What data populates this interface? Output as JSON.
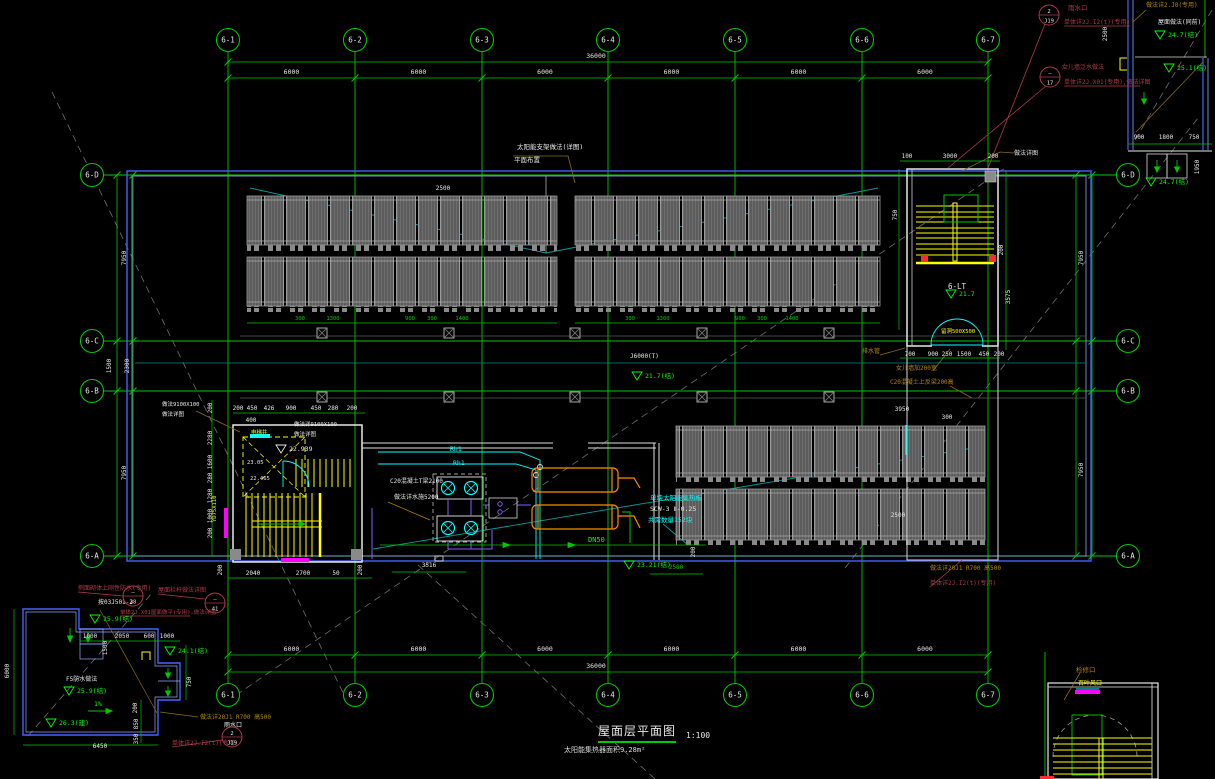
{
  "canvas": {
    "w": 1215,
    "h": 779
  },
  "palette": {
    "grid": "#00c800",
    "bright_green": "#00ff00",
    "white": "#e8e8e8",
    "cyan": "#00ffff",
    "teal": "#008c8c",
    "yellow": "#ffff00",
    "magenta": "#ff00ff",
    "orange": "#ff8c00",
    "tan": "#b8860b",
    "darkred": "#b03a48",
    "blue": "#4762ff",
    "red": "#ff2a2a",
    "panel_gray": "#787878"
  },
  "title": {
    "text": "屋面层平面图",
    "scale": "1:100",
    "note": "太阳能集热器面积9.28m²"
  },
  "axes": {
    "cols": [
      {
        "label": "6-1",
        "x": 228
      },
      {
        "label": "6-2",
        "x": 355
      },
      {
        "label": "6-3",
        "x": 482
      },
      {
        "label": "6-4",
        "x": 608
      },
      {
        "label": "6-5",
        "x": 735
      },
      {
        "label": "6-6",
        "x": 862
      },
      {
        "label": "6-7",
        "x": 988
      }
    ],
    "rows": [
      {
        "label": "6-D",
        "y": 175
      },
      {
        "label": "6-C",
        "y": 341
      },
      {
        "label": "6-B",
        "y": 391
      },
      {
        "label": "6-A",
        "y": 556
      }
    ],
    "col_bay_dim": "6000",
    "col_total_dim": "36000",
    "row_dims": [
      {
        "t": "7950",
        "x": 126,
        "y": 258,
        "r": 1
      },
      {
        "t": "1500",
        "x": 111,
        "y": 366,
        "r": 1
      },
      {
        "t": "2300",
        "x": 129,
        "y": 366,
        "r": 1
      },
      {
        "t": "7950",
        "x": 126,
        "y": 473,
        "r": 1
      },
      {
        "t": "7950",
        "x": 1083,
        "y": 258,
        "r": 1
      },
      {
        "t": "7950",
        "x": 1083,
        "y": 470,
        "r": 1
      }
    ]
  },
  "dims": [
    {
      "t": "2500",
      "x": 443,
      "y": 190
    },
    {
      "t": "100",
      "x": 907,
      "y": 158
    },
    {
      "t": "3000",
      "x": 950,
      "y": 158
    },
    {
      "t": "200",
      "x": 993,
      "y": 158
    },
    {
      "t": "200",
      "x": 1003,
      "y": 250,
      "r": 1
    },
    {
      "t": "3575",
      "x": 1010,
      "y": 297,
      "r": 1
    },
    {
      "t": "750",
      "x": 897,
      "y": 215,
      "r": 1
    },
    {
      "t": "700",
      "x": 910,
      "y": 356
    },
    {
      "t": "900",
      "x": 933,
      "y": 356
    },
    {
      "t": "250",
      "x": 947,
      "y": 356
    },
    {
      "t": "1500",
      "x": 964,
      "y": 356
    },
    {
      "t": "450",
      "x": 984,
      "y": 356
    },
    {
      "t": "200",
      "x": 999,
      "y": 356
    },
    {
      "t": "3950",
      "x": 902,
      "y": 411
    },
    {
      "t": "300",
      "x": 947,
      "y": 419
    },
    {
      "t": "2500",
      "x": 898,
      "y": 517
    },
    {
      "t": "200",
      "x": 238,
      "y": 410
    },
    {
      "t": "450",
      "x": 252,
      "y": 410
    },
    {
      "t": "426",
      "x": 269,
      "y": 410
    },
    {
      "t": "900",
      "x": 291,
      "y": 410
    },
    {
      "t": "450",
      "x": 316,
      "y": 410
    },
    {
      "t": "280",
      "x": 333,
      "y": 410
    },
    {
      "t": "200",
      "x": 352,
      "y": 410
    },
    {
      "t": "400",
      "x": 251,
      "y": 422
    },
    {
      "t": "200",
      "x": 222,
      "y": 570,
      "r": 1
    },
    {
      "t": "2040",
      "x": 253,
      "y": 575
    },
    {
      "t": "2700",
      "x": 303,
      "y": 575
    },
    {
      "t": "50",
      "x": 336,
      "y": 575
    },
    {
      "t": "200",
      "x": 362,
      "y": 570,
      "r": 1
    },
    {
      "t": "3516",
      "x": 429,
      "y": 567
    },
    {
      "t": "2500",
      "x": 676,
      "y": 569,
      "c": "g"
    },
    {
      "t": "200",
      "x": 695,
      "y": 552,
      "r": 1
    },
    {
      "t": "200",
      "x": 212,
      "y": 408,
      "r": 1
    },
    {
      "t": "2280",
      "x": 212,
      "y": 438,
      "r": 1
    },
    {
      "t": "1600",
      "x": 212,
      "y": 462,
      "r": 1
    },
    {
      "t": "280",
      "x": 212,
      "y": 478,
      "r": 1
    },
    {
      "t": "1280",
      "x": 212,
      "y": 496,
      "r": 1
    },
    {
      "t": "1000",
      "x": 212,
      "y": 516,
      "r": 1
    },
    {
      "t": "200",
      "x": 212,
      "y": 533,
      "r": 1
    },
    {
      "t": "1000",
      "x": 90,
      "y": 638
    },
    {
      "t": "2050",
      "x": 122,
      "y": 638
    },
    {
      "t": "600",
      "x": 149,
      "y": 638
    },
    {
      "t": "1000",
      "x": 167,
      "y": 638
    },
    {
      "t": "1500",
      "x": 107,
      "y": 648,
      "r": 1
    },
    {
      "t": "750",
      "x": 191,
      "y": 682,
      "r": 1
    },
    {
      "t": "200",
      "x": 137,
      "y": 708,
      "r": 1
    },
    {
      "t": "850",
      "x": 138,
      "y": 724,
      "r": 1
    },
    {
      "t": "350",
      "x": 138,
      "y": 739,
      "r": 1
    },
    {
      "t": "6450",
      "x": 100,
      "y": 748
    },
    {
      "t": "6000",
      "x": 9,
      "y": 671,
      "r": 1
    },
    {
      "t": "900",
      "x": 1139,
      "y": 139
    },
    {
      "t": "1800",
      "x": 1166,
      "y": 139
    },
    {
      "t": "750",
      "x": 1194,
      "y": 139
    },
    {
      "t": "1950",
      "x": 1199,
      "y": 167,
      "r": 1
    },
    {
      "t": "2500",
      "x": 1107,
      "y": 34,
      "r": 1
    },
    {
      "t": "300",
      "x": 300,
      "y": 320,
      "c": "g",
      "s": 5.5
    },
    {
      "t": "1300",
      "x": 333,
      "y": 320,
      "c": "g",
      "s": 5.5
    },
    {
      "t": "900",
      "x": 410,
      "y": 320,
      "c": "g",
      "s": 5.5
    },
    {
      "t": "300",
      "x": 432,
      "y": 320,
      "c": "g",
      "s": 5.5
    },
    {
      "t": "1400",
      "x": 462,
      "y": 320,
      "c": "g",
      "s": 5.5
    },
    {
      "t": "300",
      "x": 630,
      "y": 320,
      "c": "g",
      "s": 5.5
    },
    {
      "t": "1300",
      "x": 663,
      "y": 320,
      "c": "g",
      "s": 5.5
    },
    {
      "t": "900",
      "x": 740,
      "y": 320,
      "c": "g",
      "s": 5.5
    },
    {
      "t": "300",
      "x": 762,
      "y": 320,
      "c": "g",
      "s": 5.5
    },
    {
      "t": "1400",
      "x": 792,
      "y": 320,
      "c": "g",
      "s": 5.5
    }
  ],
  "annotations": [
    {
      "t": "太阳能支架做法(详图)",
      "x": 517,
      "y": 149,
      "c": "w",
      "s": 6.5
    },
    {
      "t": "平面布置",
      "x": 514,
      "y": 162,
      "c": "w",
      "s": 6.5
    },
    {
      "t": "做法详图",
      "x": 1014,
      "y": 155,
      "c": "w",
      "s": 6
    },
    {
      "t": "雨水口",
      "x": 1068,
      "y": 10,
      "c": "R",
      "s": 6.5
    },
    {
      "t": "单体详2J.I2(t)(专用)",
      "x": 1064,
      "y": 24,
      "c": "R",
      "s": 6
    },
    {
      "t": "女儿墙泛水做法",
      "x": 1062,
      "y": 69,
      "c": "R",
      "s": 6
    },
    {
      "t": "单体详2J.X01(专用),做法详图",
      "x": 1064,
      "y": 84,
      "c": "R",
      "s": 6
    },
    {
      "t": "屋面做法(同前)",
      "x": 1158,
      "y": 24,
      "c": "w",
      "s": 6
    },
    {
      "t": "做法详2.J0(专用)",
      "x": 1146,
      "y": 7,
      "c": "t",
      "s": 6
    },
    {
      "t": "排水管",
      "x": 862,
      "y": 353,
      "c": "t",
      "s": 6
    },
    {
      "t": "女儿墙加200宽",
      "x": 896,
      "y": 370,
      "c": "t",
      "s": 6
    },
    {
      "t": "C20混凝土上反梁200高",
      "x": 890,
      "y": 384,
      "c": "t",
      "s": 6
    },
    {
      "t": "C20混凝土T梁2100",
      "x": 390,
      "y": 483,
      "c": "w",
      "s": 6
    },
    {
      "t": "做法详水施5200",
      "x": 394,
      "y": 499,
      "c": "w",
      "s": 6
    },
    {
      "t": "Rh1",
      "x": 450,
      "y": 451,
      "c": "c",
      "s": 6.5
    },
    {
      "t": "Rh1",
      "x": 453,
      "y": 465,
      "c": "c",
      "s": 6.5
    },
    {
      "t": "DN50",
      "x": 588,
      "y": 542,
      "c": "G",
      "s": 7
    },
    {
      "t": "6-LT",
      "x": 948,
      "y": 289,
      "c": "w",
      "s": 7.5
    },
    {
      "t": "单块太阳能集热板",
      "x": 650,
      "y": 500,
      "c": "c",
      "s": 6.5
    },
    {
      "t": "SCW-3 Ⅱ-0.25",
      "x": 650,
      "y": 511,
      "c": "w",
      "s": 6.5
    },
    {
      "t": "共需数量152块",
      "x": 648,
      "y": 522,
      "c": "c",
      "s": 6.5
    },
    {
      "t": "做法9100X100",
      "x": 162,
      "y": 406,
      "c": "w",
      "s": 5.5
    },
    {
      "t": "做法详图",
      "x": 162,
      "y": 416,
      "c": "w",
      "s": 5.5
    },
    {
      "t": "做法详9100X100",
      "x": 294,
      "y": 426,
      "c": "w",
      "s": 5.5
    },
    {
      "t": "做法详图",
      "x": 294,
      "y": 436,
      "c": "w",
      "s": 5.5
    },
    {
      "t": "电梯井",
      "x": 251,
      "y": 434,
      "c": "y",
      "s": 5.5
    },
    {
      "t": "留洞500X500",
      "x": 941,
      "y": 333,
      "c": "y",
      "s": 5.5
    },
    {
      "t": "侧面砌体上刚性防水(专用)",
      "x": 78,
      "y": 590,
      "c": "R",
      "s": 6
    },
    {
      "t": "按03J501-2",
      "x": 98,
      "y": 604,
      "c": "w",
      "s": 6
    },
    {
      "t": "屋面栏杆做法详图",
      "x": 158,
      "y": 592,
      "c": "R",
      "s": 6
    },
    {
      "t": "单体2J.X01屋面做平(专用),做法详图",
      "x": 120,
      "y": 614,
      "c": "R",
      "s": 5.5
    },
    {
      "t": "F5防水做法",
      "x": 66,
      "y": 681,
      "c": "w",
      "s": 6
    },
    {
      "t": "1%",
      "x": 94,
      "y": 706,
      "c": "G",
      "s": 6.5
    },
    {
      "t": "做法详20J1 R700 高500",
      "x": 200,
      "y": 719,
      "c": "t",
      "s": 6
    },
    {
      "t": "雨水口",
      "x": 224,
      "y": 727,
      "c": "w",
      "s": 6
    },
    {
      "t": "单体详2J.I2(t)(专用)",
      "x": 172,
      "y": 745,
      "c": "R",
      "s": 6
    },
    {
      "t": "做法详20J1 R700 高500",
      "x": 930,
      "y": 570,
      "c": "t",
      "s": 6
    },
    {
      "t": "单体详2J.I2(t)(专用)",
      "x": 930,
      "y": 585,
      "c": "R",
      "s": 6
    },
    {
      "t": "检修口",
      "x": 1076,
      "y": 672,
      "c": "t",
      "s": 6.5
    },
    {
      "t": "百叶风口",
      "x": 1078,
      "y": 685,
      "c": "y",
      "s": 6
    },
    {
      "t": "YD75X110",
      "x": 216,
      "y": 522,
      "c": "y",
      "s": 5.5,
      "r": 1
    },
    {
      "t": "J6000(T)",
      "x": 630,
      "y": 358,
      "c": "w",
      "s": 6
    },
    {
      "t": "23.05",
      "x": 247,
      "y": 464,
      "c": "w",
      "s": 5.5
    },
    {
      "t": "22.465",
      "x": 250,
      "y": 480,
      "c": "w",
      "s": 5.5
    }
  ],
  "elevations": [
    {
      "t": "21.7",
      "x": 962,
      "y": 296,
      "c": "G"
    },
    {
      "t": "21.7(结)",
      "x": 648,
      "y": 378,
      "c": "G"
    },
    {
      "t": "22.939",
      "x": 292,
      "y": 451,
      "c": "w"
    },
    {
      "t": "23.21(结)",
      "x": 640,
      "y": 567,
      "c": "G"
    },
    {
      "t": "25.9(结)",
      "x": 106,
      "y": 621,
      "c": "G"
    },
    {
      "t": "25.9(结)",
      "x": 80,
      "y": 693,
      "c": "G"
    },
    {
      "t": "26.3(建)",
      "x": 62,
      "y": 725,
      "c": "G"
    },
    {
      "t": "24.1(结)",
      "x": 181,
      "y": 653,
      "c": "G"
    },
    {
      "t": "24.7(结)",
      "x": 1171,
      "y": 37,
      "c": "G"
    },
    {
      "t": "25.1(结)",
      "x": 1180,
      "y": 70,
      "c": "G"
    },
    {
      "t": "24.7(结)",
      "x": 1162,
      "y": 184,
      "c": "G"
    }
  ],
  "detail_circles": [
    {
      "top": "—",
      "bot": "38",
      "x": 133,
      "y": 596
    },
    {
      "top": "—",
      "bot": "41",
      "x": 215,
      "y": 603
    },
    {
      "top": "2",
      "bot": "J19",
      "x": 232,
      "y": 737
    },
    {
      "top": "2",
      "bot": "J19",
      "x": 1049,
      "y": 15
    },
    {
      "top": "—",
      "bot": "17",
      "x": 1050,
      "y": 77
    }
  ],
  "panels": {
    "blocks": [
      {
        "x": 247,
        "y": 196,
        "w": 310,
        "h": 49
      },
      {
        "x": 575,
        "y": 196,
        "w": 305,
        "h": 49
      },
      {
        "x": 247,
        "y": 257,
        "w": 310,
        "h": 49
      },
      {
        "x": 575,
        "y": 257,
        "w": 305,
        "h": 49
      },
      {
        "x": 676,
        "y": 426,
        "w": 309,
        "h": 51
      },
      {
        "x": 676,
        "y": 489,
        "w": 309,
        "h": 51
      }
    ]
  }
}
